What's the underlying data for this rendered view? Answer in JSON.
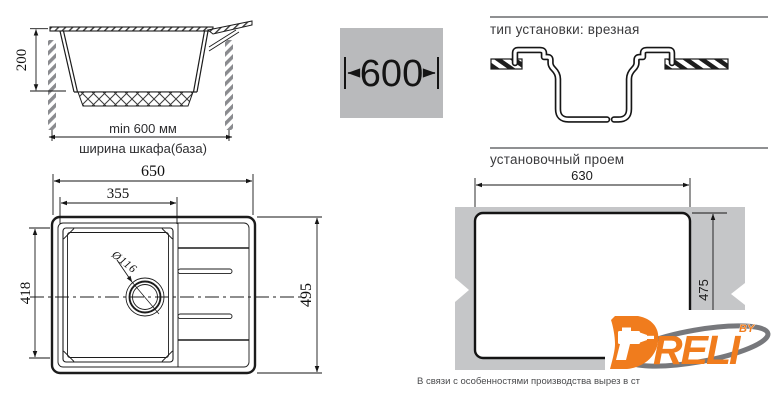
{
  "cabinet_section": {
    "height_dim": "200",
    "width_dim": "min 600 мм",
    "width_label": "ширина шкафа(база)"
  },
  "width_badge": {
    "value": "600"
  },
  "sections": {
    "installation_type_heading": "тип установки: врезная",
    "cutout_heading": "установочный проем"
  },
  "top_view": {
    "overall_width": "650",
    "bowl_width": "355",
    "bowl_depth": "418",
    "overall_depth": "495",
    "drain_diameter": "Ø116"
  },
  "cutout_view": {
    "width": "630",
    "height": "475"
  },
  "note": "В связи с особенностями производства вырез в ст",
  "logo": {
    "letters": "RELI",
    "by": "BY"
  },
  "colors": {
    "accent_orange": "#f07c1d",
    "swoosh_gray": "#77787c",
    "panel_gray": "#b9babc",
    "countertop_gray": "#c5c6c8",
    "rule_gray": "#8f9092",
    "line_dark": "#1c1c1c"
  }
}
